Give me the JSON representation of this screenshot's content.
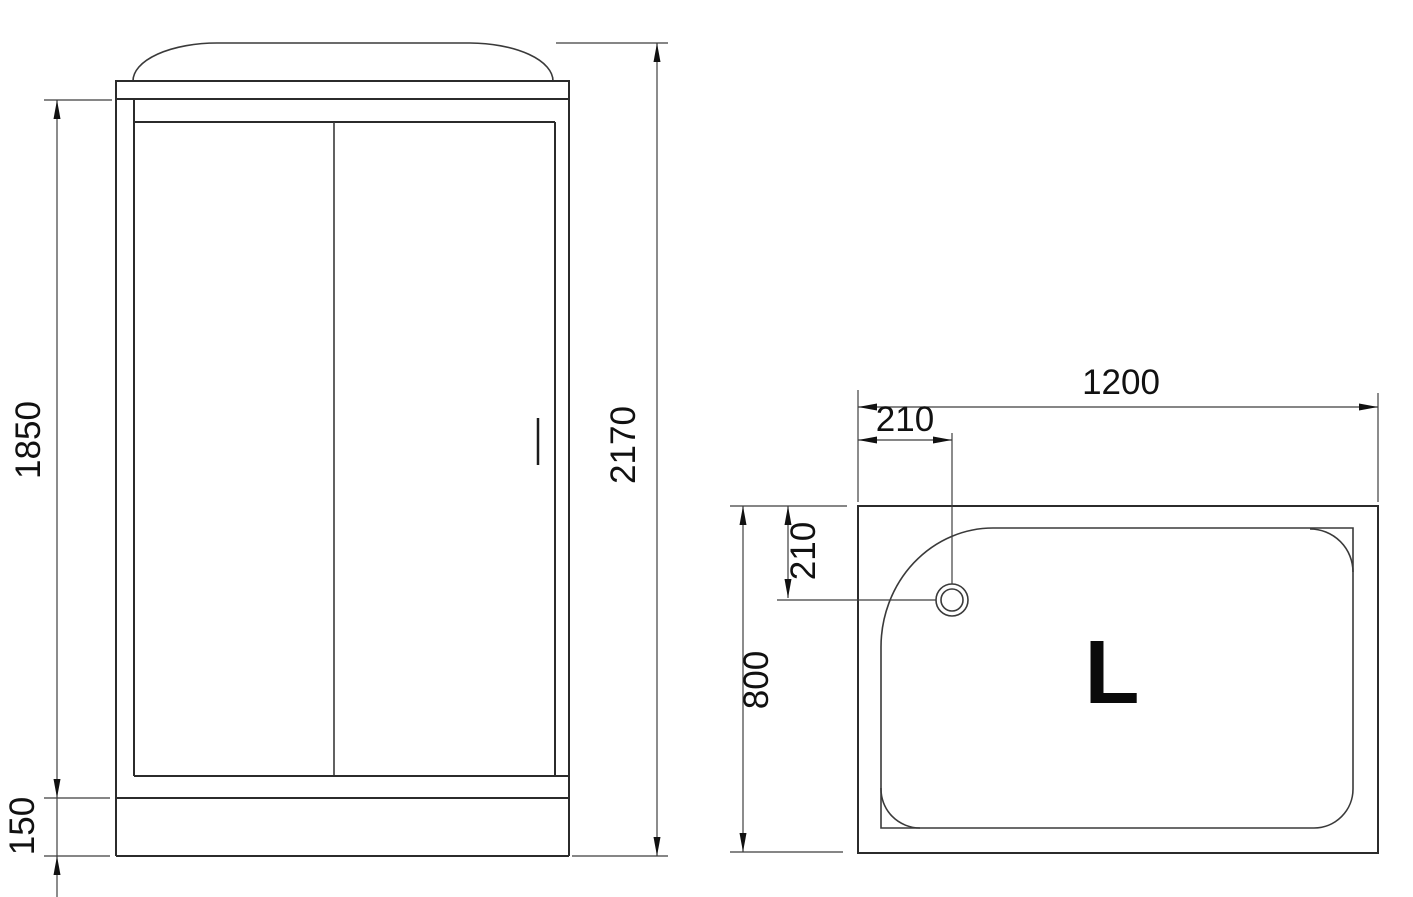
{
  "document": {
    "type": "technical-drawing",
    "subject": "shower cabin front elevation and tray plan view"
  },
  "colors": {
    "background": "#ffffff",
    "object_line": "#2b2b2b",
    "dimension_line": "#3f3f3f",
    "text": "#111111"
  },
  "front_view": {
    "dimensions": {
      "door_height": "1850",
      "tray_height": "150",
      "total_height": "2170"
    }
  },
  "top_view": {
    "dimensions": {
      "width": "1200",
      "drain_offset_left": "210",
      "drain_offset_top": "210",
      "depth": "800"
    },
    "tray_marking": "L"
  }
}
